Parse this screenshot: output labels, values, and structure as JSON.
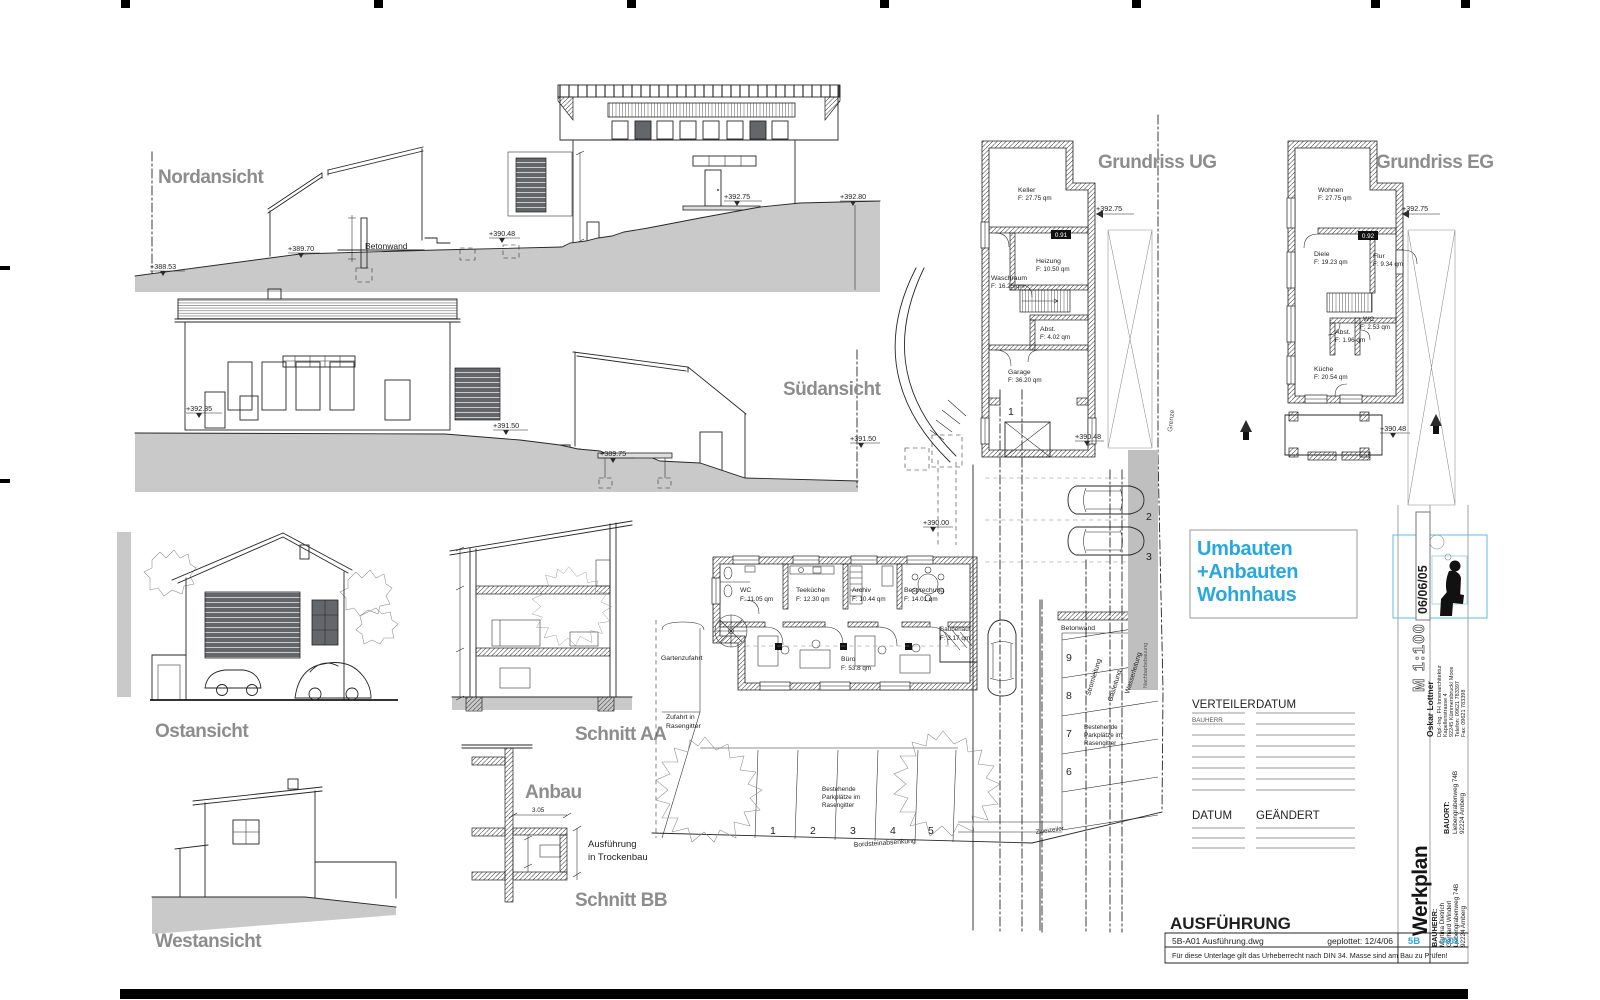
{
  "sheet": {
    "phase": "AUSFÜHRUNG",
    "file": "5B-A01 Ausführung.dwg",
    "plotted": "geplottet: 12/4/06",
    "code_left": "5B",
    "code_right": "-A01",
    "disclaimer": "Für diese Unterlage gilt das Urheberrecht nach DIN 34. Masse sind am Bau zu Prüfen!",
    "doc_type": "Werkplan",
    "scale": "M 1:100",
    "date_stamp": "06/06/05"
  },
  "project": {
    "line1": "Umbauten",
    "line2": "+Anbauten",
    "line3": "Wohnhaus"
  },
  "architect": {
    "name": "Oskar Lottner",
    "title": "Dipl.-Ing. FH Innenarchitektur",
    "street": "Kapellenstrasse 4",
    "city": "92245 Kümmersbruck/ Moos",
    "phone": "Telefon: 09621 783397",
    "fax": "Fax: 09621 783398"
  },
  "bauort": {
    "label": "BAUORT:",
    "street": "Liebengrabenweg 74B",
    "city": "92224 Amberg"
  },
  "bauherr": {
    "label": "BAUHERR:",
    "name1": "Martina Dietrich",
    "name2": "Gerhard Winderl",
    "street": "Liebengrabenweg 74B",
    "city": "92224 Amberg"
  },
  "verteiler": {
    "col1": "VERTEILER",
    "col2": "DATUM",
    "row1": "BAUHERR",
    "col3": "DATUM",
    "col4": "GEÄNDERT"
  },
  "views": {
    "nord": {
      "label": "Nordansicht",
      "betonwand": "Betonwand",
      "m1": "+388.53",
      "m2": "+389.70",
      "m3": "+390.48",
      "m4": "+392.75",
      "m5": "+392.80"
    },
    "sued": {
      "label": "Südansicht",
      "m1": "+392.35",
      "m2": "+391.50",
      "m3": "+389.75",
      "m4": "+391.50"
    },
    "ost": {
      "label": "Ostansicht"
    },
    "west": {
      "label": "Westansicht"
    },
    "schnitt_aa": {
      "label": "Schnitt AA"
    },
    "schnitt_bb": {
      "label": "Schnitt BB"
    },
    "anbau": {
      "label": "Anbau",
      "note1": "Ausführung",
      "note2": "in Trockenbau",
      "dim": "3.05"
    }
  },
  "ug": {
    "label": "Grundriss UG",
    "level": "+392.75",
    "badge": "0.91",
    "keller_n": "Keller",
    "keller_a": "F: 27.75 qm",
    "heizung_n": "Heizung",
    "heizung_a": "F: 10.50 qm",
    "waschraum_n": "Waschraum",
    "waschraum_a": "F: 16.25 qm",
    "abst_n": "Abst.",
    "abst_a": "F: 4.02 qm",
    "garage_n": "Garage",
    "garage_a": "F: 36.20 qm",
    "m_390": "+390.00",
    "m_39048": "+390.48",
    "grenze": "Grenze",
    "stall": "1"
  },
  "eg": {
    "label": "Grundriss EG",
    "level": "+392.75",
    "badge": "0.92",
    "wohnen_n": "Wohnen",
    "wohnen_a": "F: 27.75 qm",
    "diele_n": "Diele",
    "diele_a": "F: 19.23 qm",
    "flur_n": "Flur",
    "flur_a": "F: 9.34 qm",
    "wc_n": "WC",
    "wc_a": "F: 2.53 qm",
    "abst_n": "Abst.",
    "abst_a": "F: 1.96 qm",
    "kueche_n": "Küche",
    "kueche_a": "F: 20.54 qm",
    "m_39048": "+390.48"
  },
  "buero": {
    "wc_n": "WC",
    "wc_a": "F: 11.05 qm",
    "teekueche_n": "Teeküche",
    "teekueche_a": "F: 12.30 qm",
    "archiv_n": "Archiv",
    "archiv_a": "F: 10.44 qm",
    "besprechung_n": "Besprechung",
    "besprechung_a": "F: 14.01 qm",
    "sauberlauf_n": "Sauberlauf",
    "sauberlauf_a": "F: 3.17 qm",
    "buero_n": "Büro",
    "buero_a": "F: 53.8 qm"
  },
  "site": {
    "gartenzufahrt": "Gartenzufahrt",
    "zufahrt1": "Zufahrt in",
    "zufahrt2": "Rasengitter",
    "best1": "Bestehende",
    "best2": "Parkplätze im",
    "best3": "Rasengitter",
    "zweizeiler": "Zweizeiler",
    "bordstein": "Bordsteinabsenkung",
    "betonwand": "Betonwand",
    "strom": "Stromleitung",
    "gas": "Gasleitung",
    "wasser": "Wasserleitung",
    "nachbar": "Nachbarbebauung",
    "s2": "2",
    "s3": "3",
    "s6": "6",
    "s7": "7",
    "s8": "8",
    "s9": "9",
    "b1": "1",
    "b2": "2",
    "b3": "3",
    "b4": "4",
    "b5": "5"
  }
}
